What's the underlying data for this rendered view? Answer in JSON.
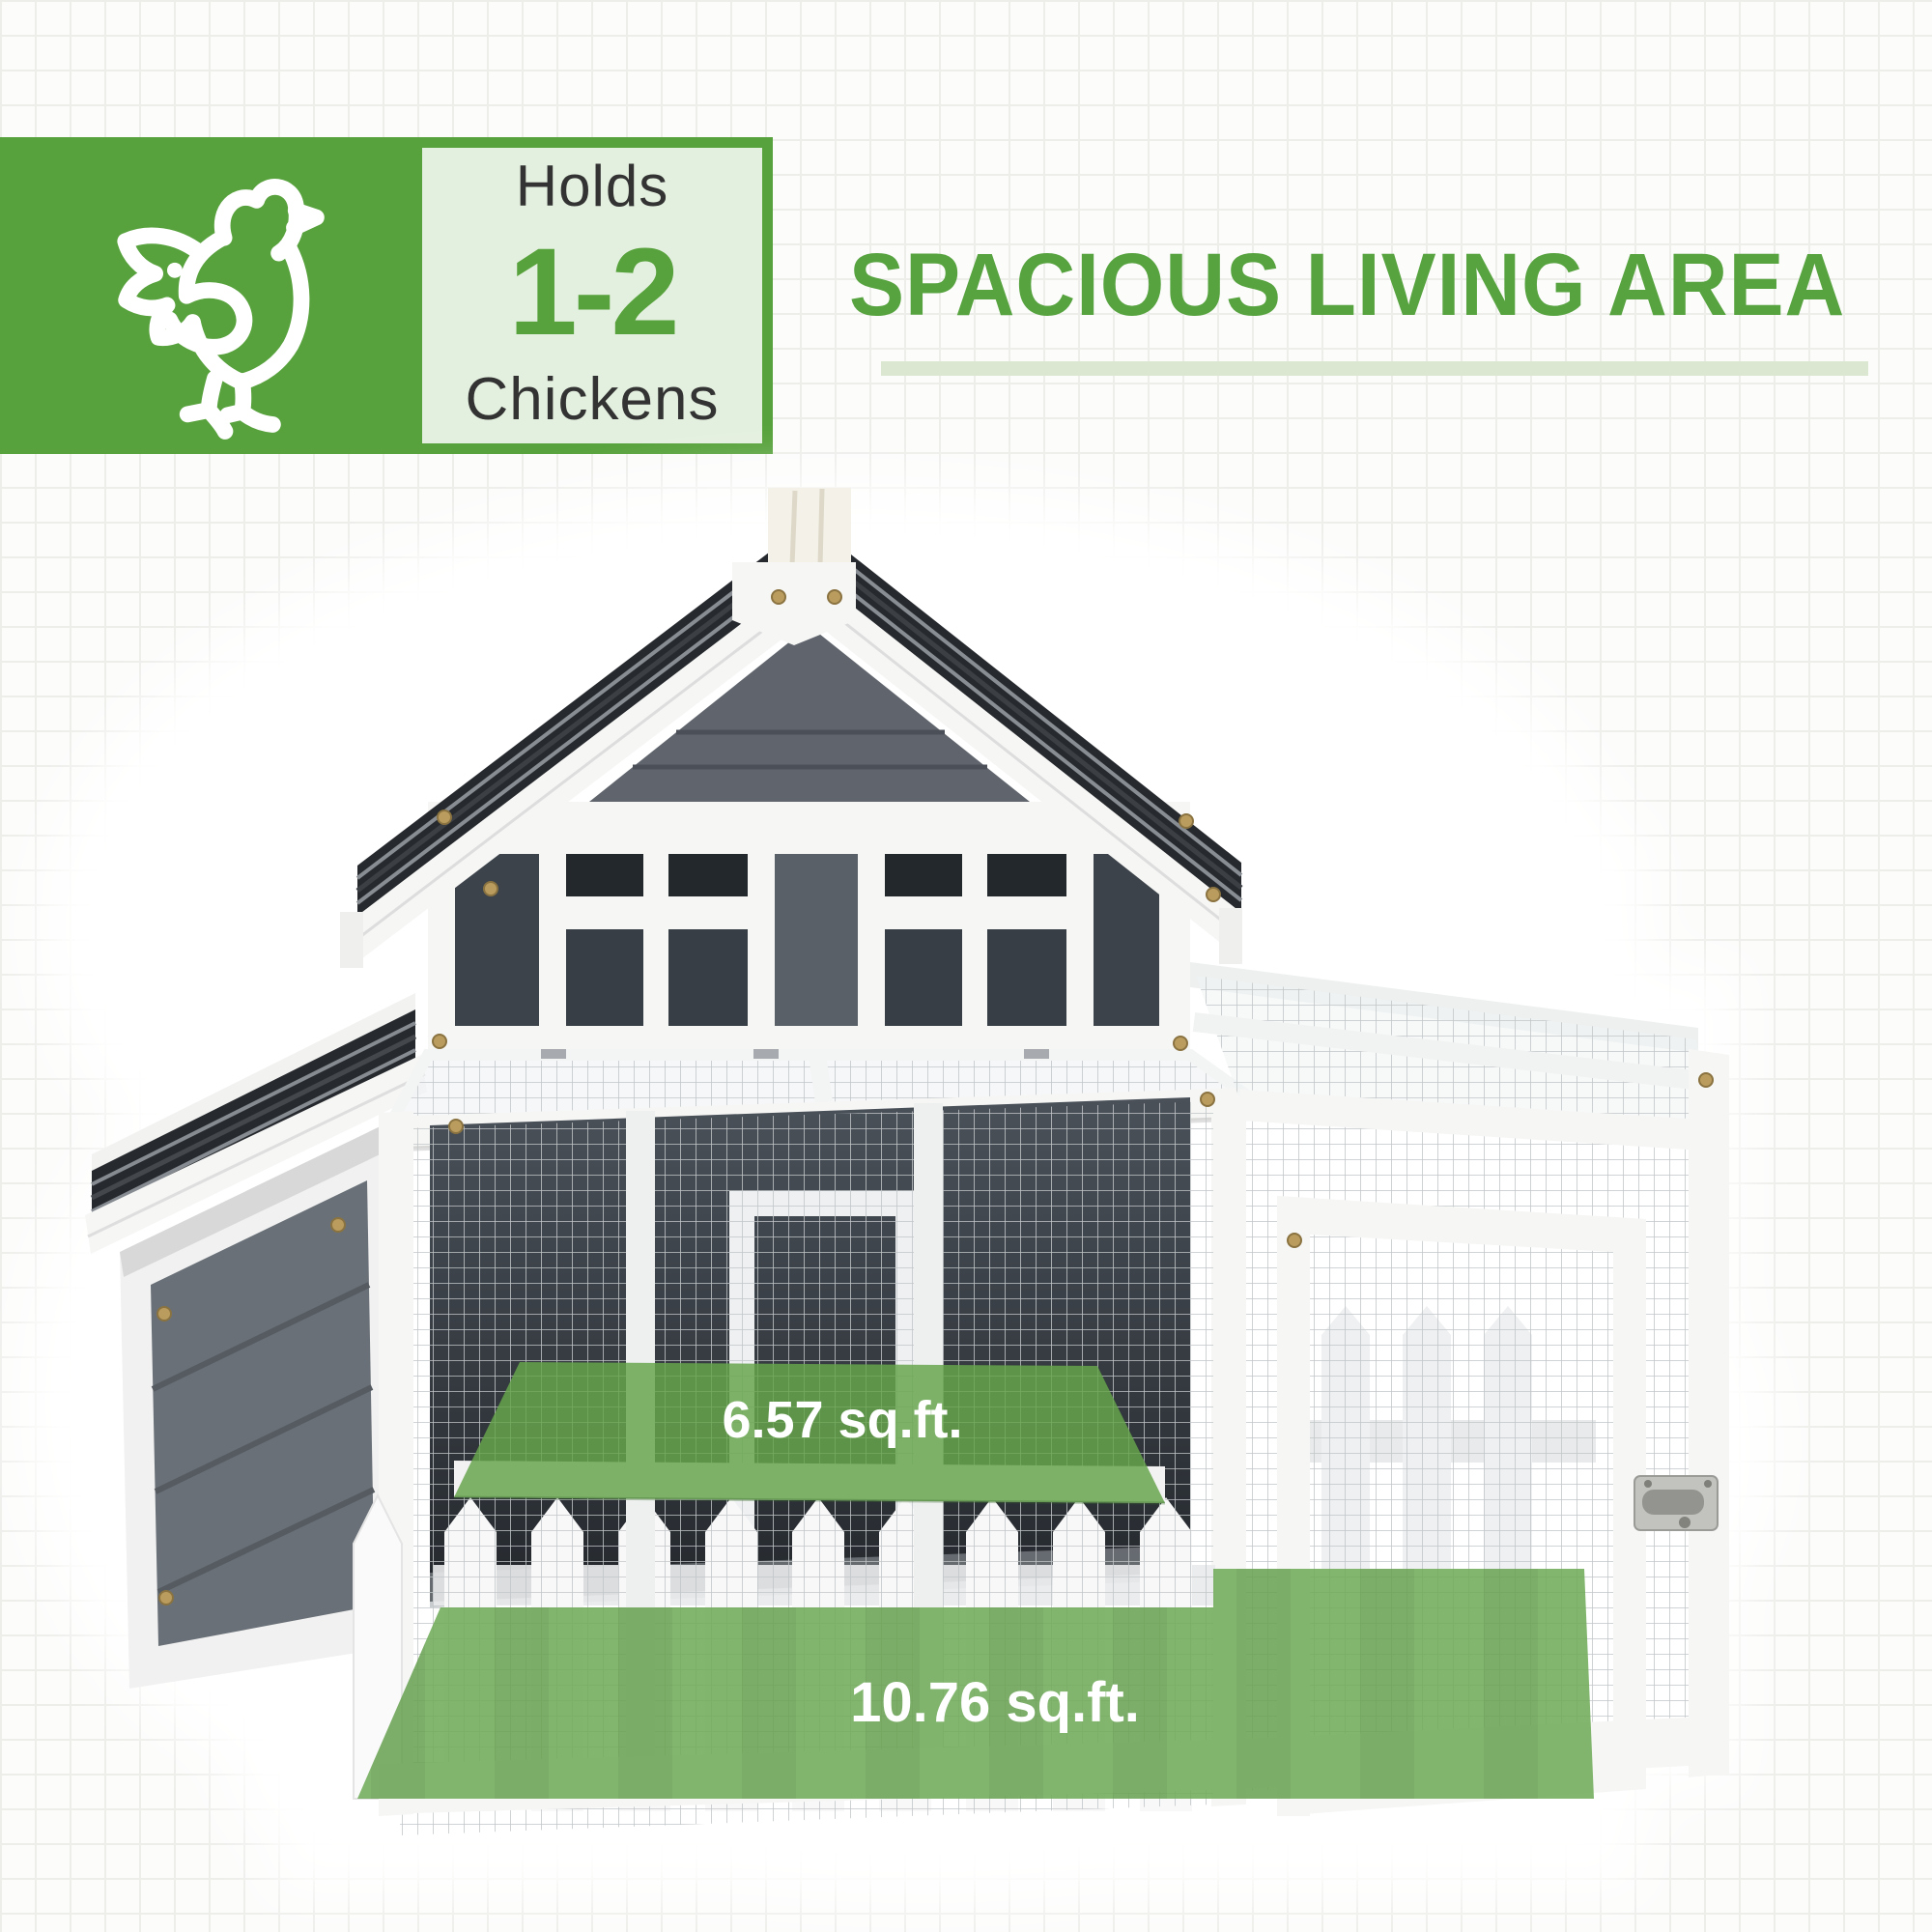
{
  "badge": {
    "icon": "chicken-icon",
    "line_top": "Holds",
    "line_number": "1-2",
    "line_bottom": "Chickens"
  },
  "heading": {
    "title": "SPACIOUS LIVING AREA"
  },
  "overlays": {
    "upper_platform_label": "6.57 sq.ft.",
    "ground_area_label": "10.76 sq.ft."
  },
  "colors": {
    "brand_green": "#57a23c",
    "heading_green": "#57a33f",
    "underline_green": "#dbe7d0",
    "overlay_green": "#6caa52",
    "badge_text_dark": "#333333",
    "label_white": "#ffffff",
    "coop_gray": "#5a6067",
    "coop_dark": "#2c3137"
  }
}
